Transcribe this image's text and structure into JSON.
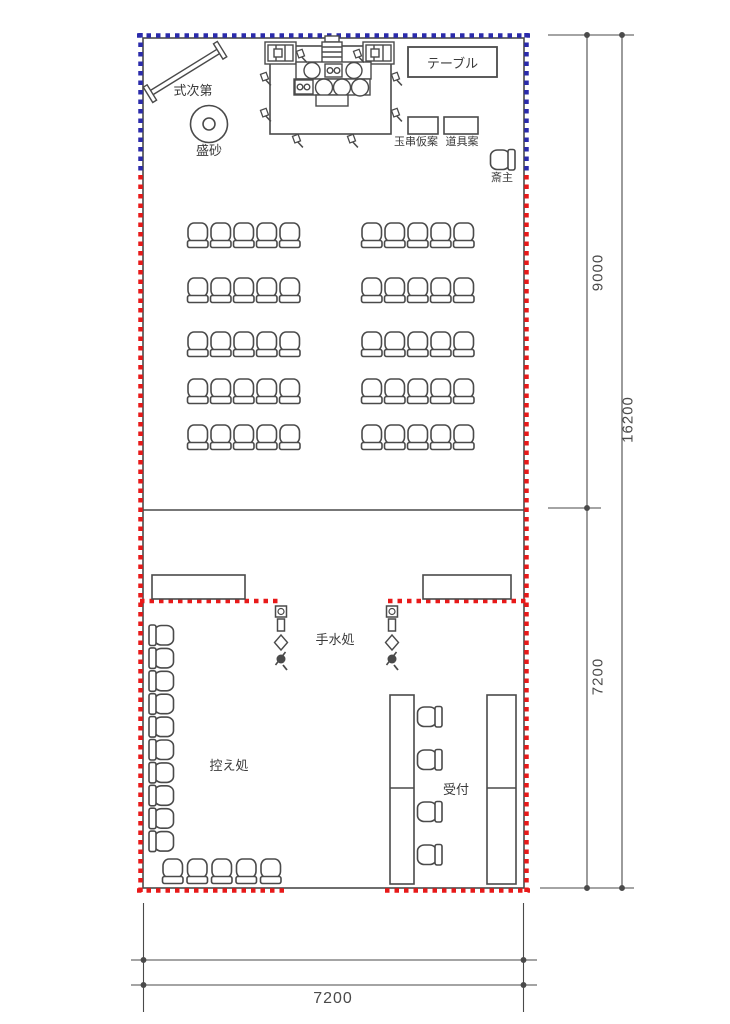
{
  "title": "ceremony hall floor plan",
  "colors": {
    "line": "#4a4a4a",
    "blue_border": "#2b2bab",
    "red_border": "#e81919",
    "text": "#3a3a3a",
    "background": "#ffffff"
  },
  "labels": {
    "shikishidai": "式次第",
    "morisuna": "盛砂",
    "table": "テーブル",
    "tamagushi_karian": "玉串仮案",
    "dougu_an": "道具案",
    "saishu": "斎主",
    "temizudokoro": "手水処",
    "hikaedokoro": "控え処",
    "uketsuke": "受付"
  },
  "dimensions": {
    "upper_section_height": "9000",
    "total_height": "16200",
    "lower_section_height": "7200",
    "width": "7200"
  },
  "seating": {
    "main_hall": {
      "rows": 5,
      "blocks": 2,
      "chairs_per_block_row": 5
    },
    "waiting": {
      "left_column_chairs": 10,
      "bottom_row_chairs": 5
    },
    "reception": {
      "chairs": 4,
      "tables": 2
    },
    "priest_chairs": 1
  }
}
